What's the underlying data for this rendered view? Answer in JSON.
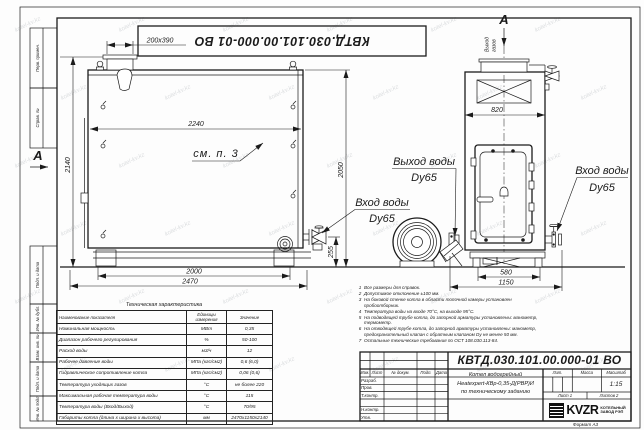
{
  "watermark": "kotel-kv.kz",
  "top_stamp": "КВТД.030.101.00.000-01 ВО",
  "border_labels": [
    "Перв. примен.",
    "Справ. №",
    "Подп. и дата",
    "Инв. № дубл.",
    "Взам. инв. №",
    "Подп. и дата",
    "Инв. № подл."
  ],
  "left_view": {
    "section_label": "А",
    "dim_duct": "200x390",
    "dim_inner_width": "2240",
    "dim_height": "2140",
    "dim_height_right": "2050",
    "dim_feet": "2000",
    "dim_length": "2470",
    "dim_pipe_height": "255",
    "see_note": "см. п. 3"
  },
  "right_view": {
    "view_label": "А",
    "flue_word1": "Выход",
    "flue_word2": "газов",
    "dim_top_width": "820",
    "dim_base": "580",
    "dim_width": "1150",
    "outlet_label": "Выход воды",
    "outlet_dn": "Dy65",
    "inlet_label": "Вход воды",
    "inlet_dn": "Dy65",
    "inlet2_label": "Вход воды",
    "inlet2_dn": "Dy65"
  },
  "notes": [
    "Все размеры для справок.",
    "Допустимое отклонение ±100 мм.",
    "На боковой стенке котла в области топочной камеры установлен пробоотборник.",
    "Температура воды на входе 70°С, на выходе 95°С.",
    "На подводящей трубе котла, до запорной арматуры установлены: манометр, термометр.",
    "На отводящей трубе котла, до запорной арматуры установлены: манометр, предохранительный клапан с обратным клапаном Dу не менее 50 мм.",
    "Остальные технические требования по ОСТ 108.030.113-84."
  ],
  "table": {
    "title": "Техническая характеристика",
    "headers": [
      "Наименование показателя",
      "Единицы измерения",
      "Значение"
    ],
    "rows": [
      [
        "Номинальная мощность",
        "МВт",
        "0,35"
      ],
      [
        "Диапазон рабочего регулирования",
        "%",
        "50-100"
      ],
      [
        "Расход воды",
        "м3/ч",
        "12"
      ],
      [
        "Рабочее давление воды",
        "МПа (кгс/см2)",
        "0,6 (6,0)"
      ],
      [
        "Гидравлическое сопротивление котла",
        "МПа (кгс/см2)",
        "0,06 (0,6)"
      ],
      [
        "Температура уходящих газов",
        "°С",
        "не более 220"
      ],
      [
        "Максимальная рабочая температура воды",
        "°С",
        "115"
      ],
      [
        "Температура воды (Вход/Выход)",
        "°С",
        "70/95"
      ],
      [
        "Габариты котла (длина х ширина х высота)",
        "мм",
        "2470х1150х2140"
      ]
    ]
  },
  "titleblock": {
    "doc_number": "КВТД.030.101.00.000-01 ВО",
    "product_line1": "Котел водогрейный",
    "product_line2": "Heatexpert-КВр-0,35-Д(РВР)И",
    "product_line3": "по техническому заданию",
    "header_cells": [
      "Изм.",
      "Лист",
      "№ докум.",
      "Подп.",
      "Дата"
    ],
    "roles": [
      "Разраб.",
      "Пров.",
      "Т.контр.",
      "Н.контр.",
      "Утв."
    ],
    "lit_label": "Лит.",
    "mass_label": "Масса",
    "scale_label": "Масштаб",
    "scale_value": "1:15",
    "sheet": "Лист 1",
    "sheets": "Листов 2",
    "logo_text": "KVZR",
    "company_line1": "КОТЕЛЬНЫЙ",
    "company_line2": "ЗАВОД РЭП",
    "format_label": "Формат А3"
  }
}
